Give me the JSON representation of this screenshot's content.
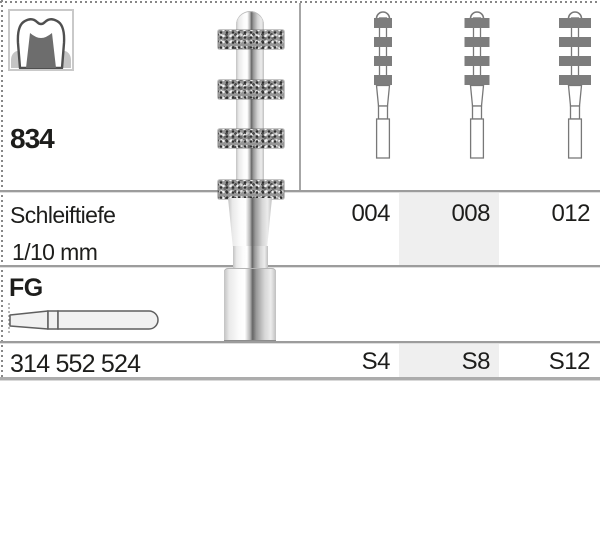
{
  "colors": {
    "highlight": "#efefef",
    "rule_gray": "#9c9c9c",
    "ring_bar_gray": "#7d7d7d",
    "text": "#1d1d1b"
  },
  "product": {
    "figure": "834",
    "depth_label": "Schleiftiefe",
    "depth_unit": "1/10 mm",
    "shank": "FG",
    "order_number": "314 552 524"
  },
  "columns": [
    {
      "size": "004",
      "code": "S4",
      "ring_width_px": 18,
      "highlighted": false
    },
    {
      "size": "008",
      "code": "S8",
      "ring_width_px": 25,
      "highlighted": true
    },
    {
      "size": "012",
      "code": "S12",
      "ring_width_px": 32,
      "highlighted": false
    }
  ],
  "icons": {
    "tooth": "crown-preparation-tooth-icon",
    "main_illustration": "diamond-depth-marker-bur",
    "mini_diagram": "bur-size-schematic-icon",
    "fg_shank": "fg-shank-profile-icon"
  }
}
